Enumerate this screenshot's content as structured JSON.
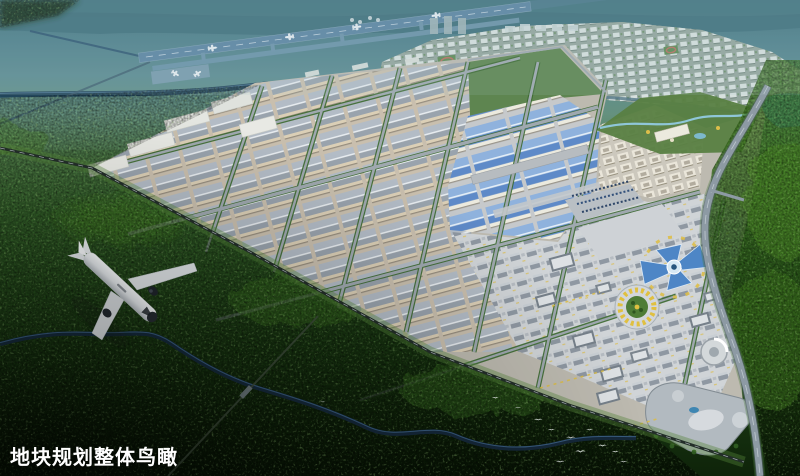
{
  "caption": {
    "text": "地块规划整体鸟瞰",
    "color": "#ffffff"
  },
  "scene": {
    "type": "aerial-masterplan-rendering",
    "colors": {
      "haze_top": "#4f808b",
      "forest_bright": "#3f7c1f",
      "forest_dark": "#15300f",
      "river": "#16293c",
      "runway": "#5c85a2",
      "warehouse_roof": "#a7b0ba",
      "warehouse_wall": "#dbcfb6",
      "blue_roof": "#6f9bd4",
      "highway": "#8d9aa4",
      "accent_yellow": "#ddbe4a",
      "butterfly_blue": "#4e86c6",
      "caption_white": "#ffffff"
    },
    "elements": [
      "airport-runway",
      "parked-aircraft",
      "residential-district",
      "sports-fields",
      "industrial-park",
      "beige-warehouse-rows",
      "blue-roof-warehouses",
      "dormitory-blocks",
      "parking-lot",
      "central-plaza",
      "butterfly-exhibition-center",
      "circular-plaza",
      "shopping-mall-complex",
      "round-tower",
      "landscaped-park",
      "lake",
      "highway",
      "railway-line",
      "winding-river",
      "rural-road",
      "forest-hills",
      "egret-flock",
      "airliner"
    ]
  }
}
